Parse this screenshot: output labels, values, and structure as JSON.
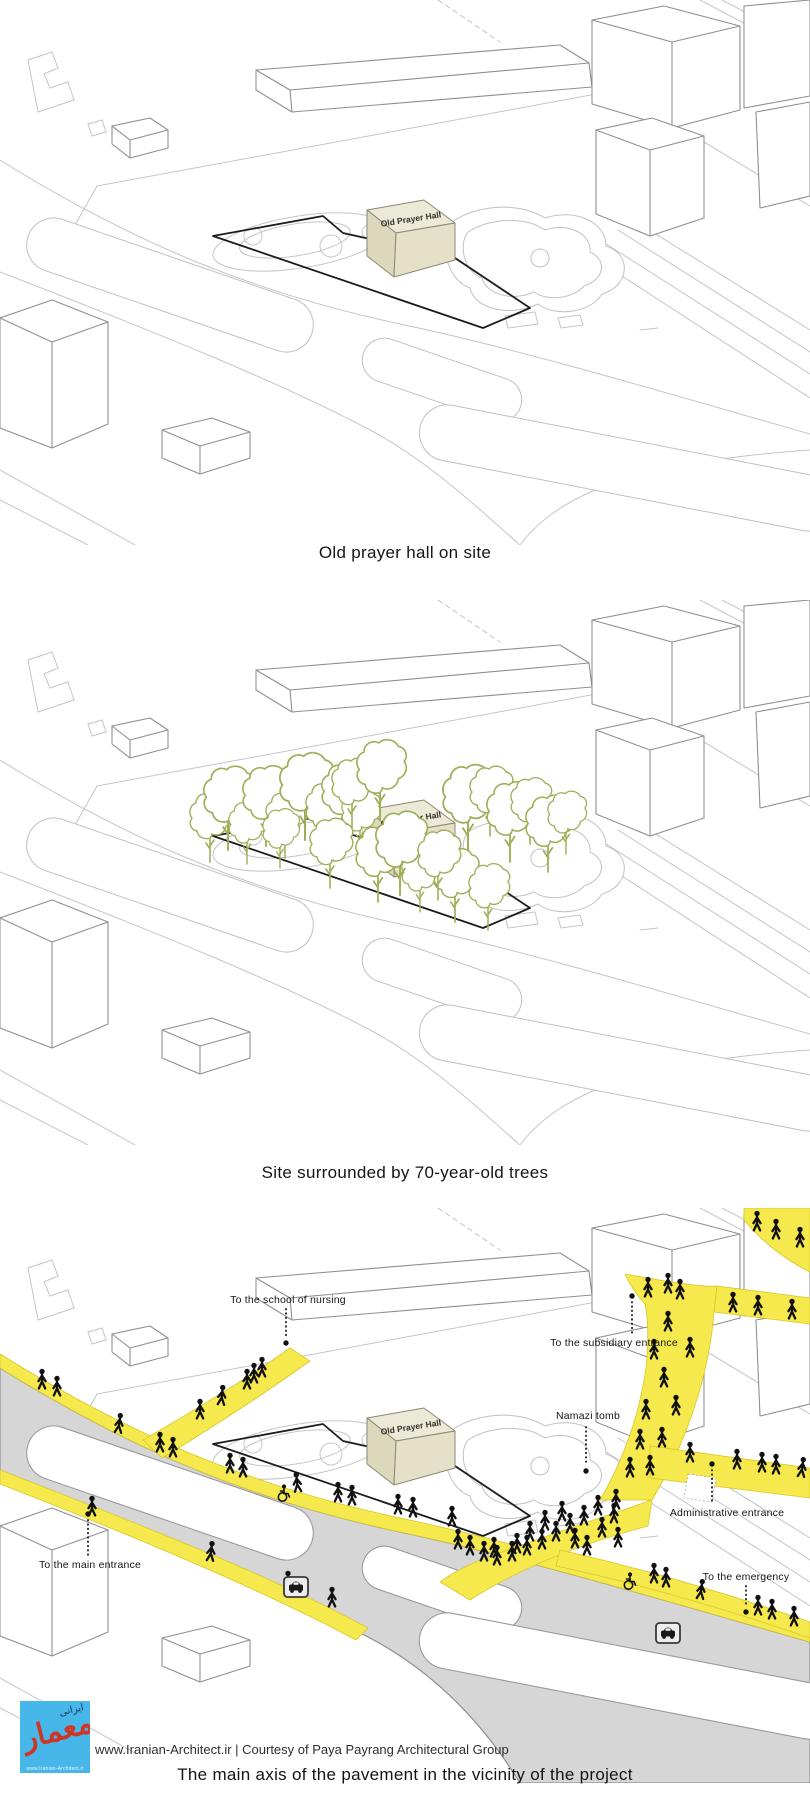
{
  "panels": [
    {
      "caption": "Old prayer hall on site",
      "cube_label": "Old Prayer Hall"
    },
    {
      "caption": "Site surrounded by 70-year-old trees",
      "cube_label": "Old Prayer Hall"
    },
    {
      "caption": "The main axis of the pavement in the vicinity of the project",
      "cube_label": "Old Prayer Hall",
      "labels": {
        "school_of_nursing": "To the school of nursing",
        "subsidiary_entrance": "To the subsidiary entrance",
        "namazi_tomb": "Namazi tomb",
        "administrative_entrance": "Administrative entrance",
        "main_entrance": "To the main entrance",
        "emergency": "To the emergency"
      }
    }
  ],
  "footer": {
    "credit": "www.Iranian-Architect.ir | Courtesy of Paya Payrang Architectural Group",
    "logo_text": "معمار",
    "logo_subtext": "ایرانی",
    "logo_url": "www.Iranian-Architect.ir"
  },
  "colors": {
    "pavement_yellow": "#F5E94E",
    "tree_green": "#9FAE58",
    "cube_beige": "#ECE9D6",
    "road_gray": "#D6D6D6"
  }
}
